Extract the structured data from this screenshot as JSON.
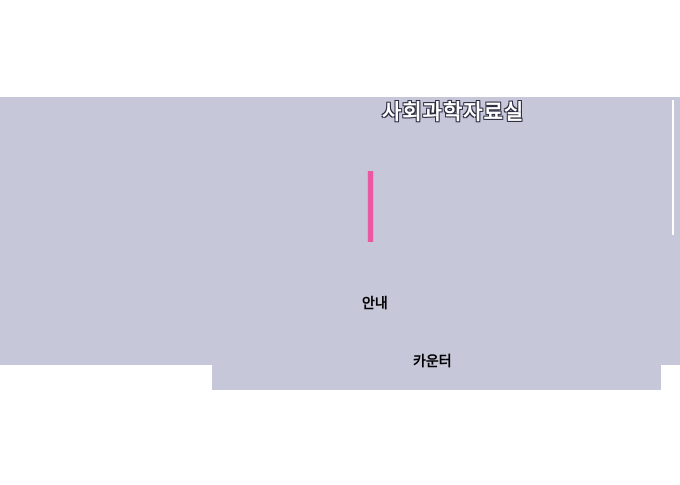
{
  "page": {
    "background_color": "#ffffff",
    "panel_color": "#c7c7da",
    "title": "사회과학자료실",
    "title_color": "#ffffff",
    "title_outline_color": "#2b2b40"
  },
  "map": {
    "highlight_bar_color": "#eb58a2",
    "highlight_bar_edge_color": "#f29fc9",
    "labels": [
      {
        "text": "안내"
      },
      {
        "text": "카운터"
      }
    ]
  }
}
